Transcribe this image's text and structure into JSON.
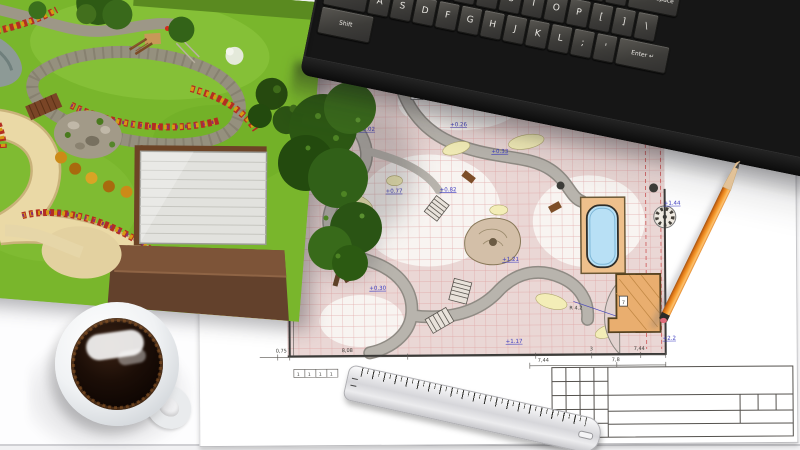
{
  "scene": {
    "objects": [
      "garden-3d-render",
      "landscape-blueprint",
      "computer-keyboard",
      "pencil",
      "metal-ruler",
      "coffee-cup"
    ]
  },
  "keyboard": {
    "digit_row": [
      "`",
      "1",
      "2",
      "3",
      "4",
      "5",
      "6",
      "7",
      "8",
      "9",
      "0",
      "-",
      "="
    ],
    "backspace": "← Backspace",
    "tab": "Tab",
    "qwerty_row": [
      "Q",
      "W",
      "E",
      "R",
      "T",
      "Y",
      "U",
      "I",
      "O",
      "P",
      "[",
      "]",
      "\\"
    ],
    "caps": "Caps Lock",
    "home_row": [
      "A",
      "S",
      "D",
      "F",
      "G",
      "H",
      "J",
      "K",
      "L",
      ";",
      "'"
    ],
    "enter": "Enter ↵",
    "shift_left": "Shift",
    "shift_right": "Shift",
    "bottom_row": [
      "Ctrl",
      "Alt",
      "",
      "Alt",
      "≡",
      "Ctrl"
    ],
    "nav_keys": [
      "Insert",
      "Home",
      "Page Up",
      "Delete",
      "End",
      "Page Down"
    ],
    "arrow_keys": [
      "↑",
      "←",
      "↓",
      "→"
    ],
    "numpad": [
      [
        "Num Lock",
        "/",
        "*",
        "-"
      ],
      [
        "7 Home",
        "8 ↑",
        "9 PgUp",
        "+"
      ],
      [
        "4 ←",
        "5",
        "6 →"
      ],
      [
        "1 End",
        "2 ↓",
        "3 PgDn",
        "Enter"
      ],
      [
        "0 Ins",
        ". Del"
      ]
    ]
  },
  "blueprint": {
    "elevation_marks": [
      "+0.02",
      "+0.26",
      "+0.33",
      "+0.82",
      "+0.77",
      "+0.30",
      "+1.21",
      "+1.17",
      "+1.44",
      "+2.2"
    ],
    "dim_row_upper": [
      "0,75",
      "8,08",
      "3",
      "7,44"
    ],
    "dim_row_lower": [
      "7,44",
      "7,8"
    ],
    "dim_chain_small": [
      "1",
      "1",
      "1",
      "1"
    ],
    "radius_label": "R 4.2",
    "room_number": "7",
    "area_label": "50",
    "scatter_dims": [
      "1,62",
      "2,47",
      "2,84",
      "7,13",
      "3,01",
      "8,72",
      "5,6",
      "3,8",
      "1,12",
      "6,35",
      "1,95",
      "0,4",
      "2,12",
      "8,59",
      "1,4",
      "3,2",
      "1,05",
      "0,93"
    ]
  },
  "ruler": {
    "numbers": [
      "1",
      "2",
      "3",
      "4",
      "5",
      "6",
      "7",
      "8",
      "9",
      "10",
      "11",
      "12",
      "13",
      "14",
      "15",
      "16",
      "17",
      "18",
      "19",
      "20"
    ],
    "red_numbers": [
      "10",
      "20"
    ]
  },
  "colors": {
    "pencil_orange": "#e8862a",
    "pool_blue": "#b8e0f5",
    "grid_pink": "#dc9898",
    "elevation_blue": "#3a3ac0",
    "ruler_red": "#c42020",
    "lawn_green": "#79b62c",
    "roof_brown": "#6a452f",
    "keyboard_black": "#161616",
    "deck_tan": "#eec08c",
    "coffee_dark": "#190d07"
  }
}
